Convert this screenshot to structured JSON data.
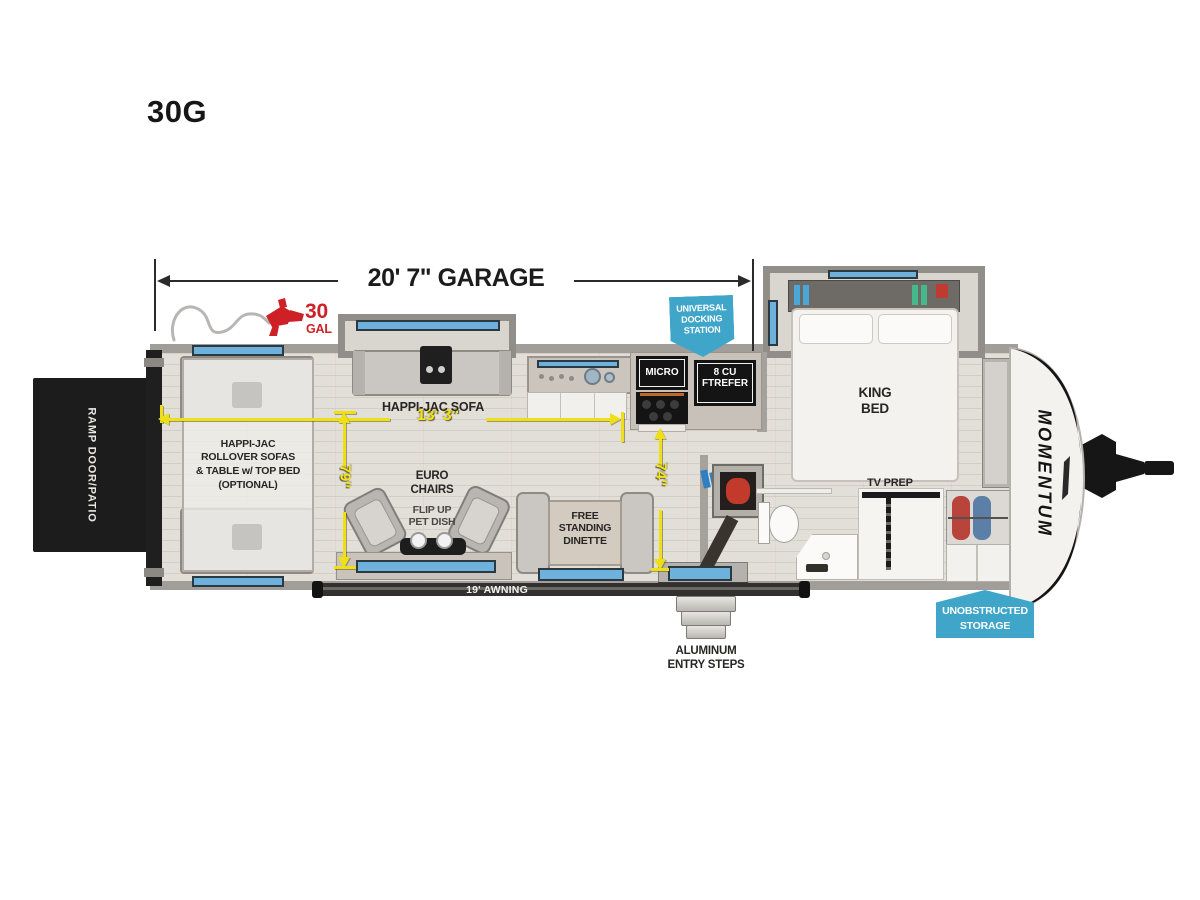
{
  "title": "30G",
  "colors": {
    "accent_blue": "#3fa6c9",
    "dim_yellow": "#eee015",
    "fuel_red": "#cd2127"
  },
  "dimensions": {
    "garage_length": "20' 7\" GARAGE",
    "sofa_run": "13' 3\"",
    "garage_width": "79\"",
    "living_width": "74\"",
    "awning_length": "19' AWNING"
  },
  "fuel": {
    "value": "30",
    "unit": "GAL"
  },
  "badges": {
    "docking_lines": [
      "UNIVERSAL",
      "DOCKING",
      "STATION"
    ],
    "storage_lines": [
      "UNOBSTRUCTED",
      "STORAGE"
    ]
  },
  "labels": {
    "ramp_door": "RAMP DOOR/PATIO",
    "rollover_lines": [
      "HAPPI-JAC",
      "ROLLOVER SOFAS",
      "& TABLE w/ TOP BED",
      "(OPTIONAL)"
    ],
    "happijac_sofa": "HAPPI-JAC SOFA",
    "euro_chairs_lines": [
      "EURO",
      "CHAIRS"
    ],
    "pet_dish_lines": [
      "FLIP UP",
      "PET DISH"
    ],
    "dinette_lines": [
      "FREE",
      "STANDING",
      "DINETTE"
    ],
    "micro": "MICRO",
    "refer_lines": [
      "8 CU FT",
      "REFER"
    ],
    "king_bed_lines": [
      "KING",
      "BED"
    ],
    "tv_prep": "TV PREP",
    "steps_lines": [
      "ALUMINUM",
      "ENTRY STEPS"
    ],
    "brand": "MOMENTUM"
  }
}
